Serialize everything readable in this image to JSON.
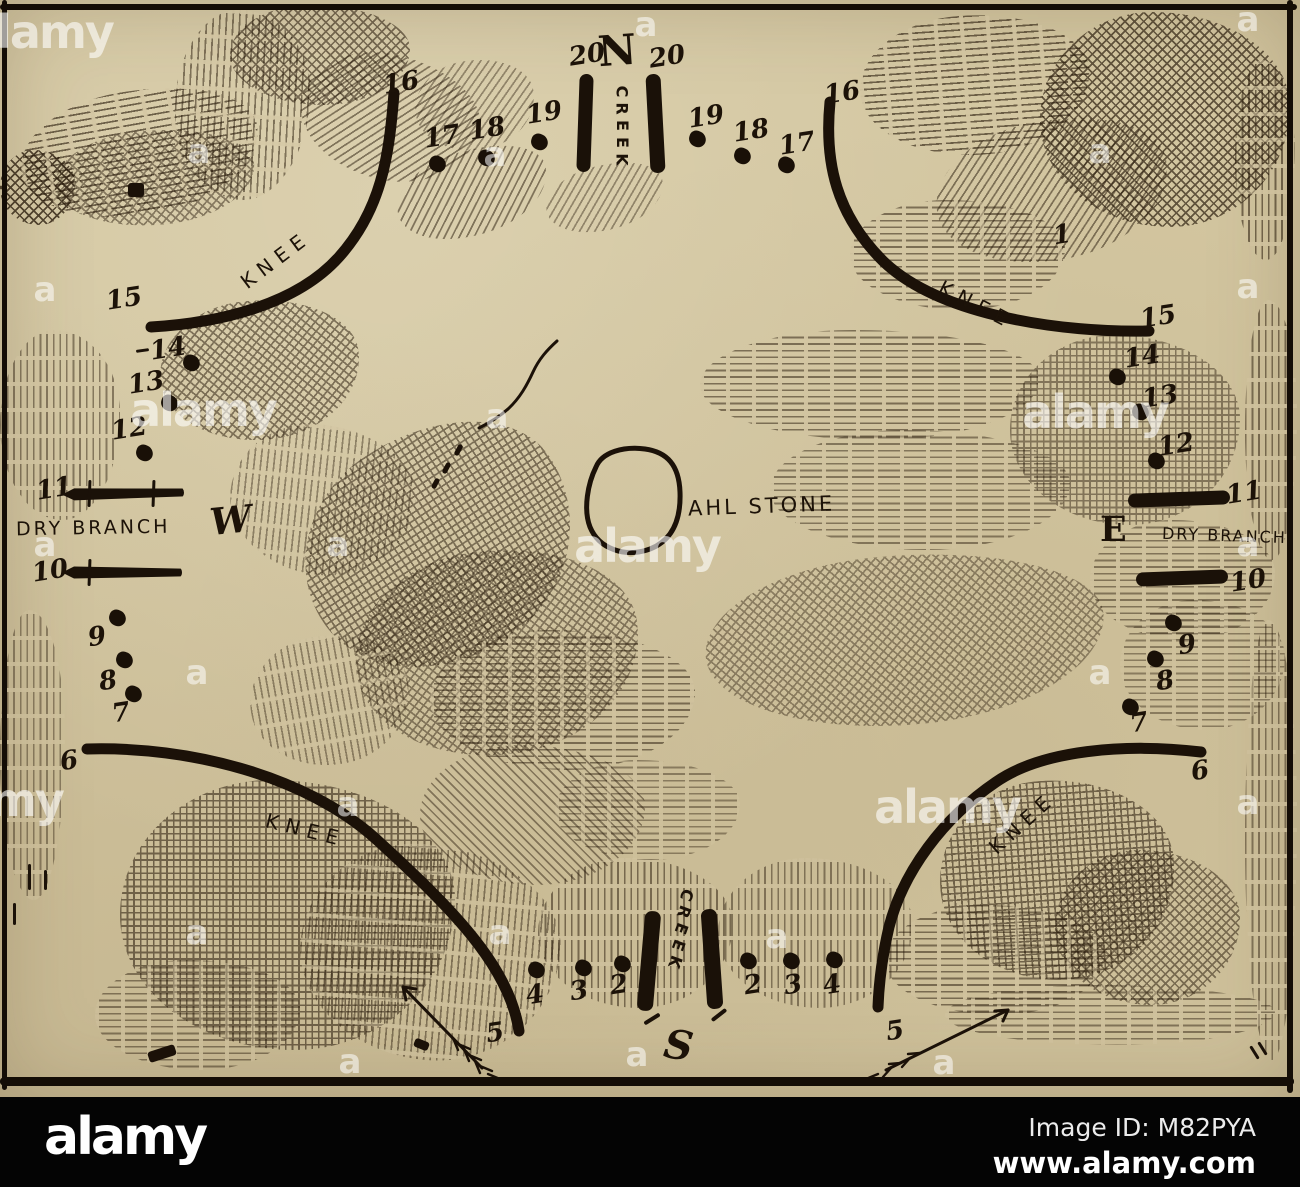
{
  "footer": {
    "logo": "alamy",
    "image_id": "Image ID: M82PYA",
    "url": "www.alamy.com"
  },
  "watermark": {
    "word": "alamy",
    "letter": "a",
    "word_tiles": [
      [
        40,
        32
      ],
      [
        203,
        410
      ],
      [
        1095,
        412
      ],
      [
        647,
        546
      ],
      [
        -10,
        800
      ],
      [
        947,
        807
      ]
    ],
    "letter_tiles": [
      [
        646,
        25
      ],
      [
        1248,
        20
      ],
      [
        199,
        152
      ],
      [
        495,
        155
      ],
      [
        1100,
        152
      ],
      [
        45,
        290
      ],
      [
        1248,
        287
      ],
      [
        497,
        417
      ],
      [
        45,
        545
      ],
      [
        338,
        545
      ],
      [
        1248,
        545
      ],
      [
        197,
        673
      ],
      [
        1100,
        673
      ],
      [
        348,
        805
      ],
      [
        1248,
        803
      ],
      [
        197,
        933
      ],
      [
        500,
        933
      ],
      [
        777,
        937
      ],
      [
        350,
        1062
      ],
      [
        637,
        1055
      ],
      [
        944,
        1063
      ]
    ]
  },
  "map": {
    "compass": {
      "north": "N",
      "south": "S",
      "east": "E",
      "west": "W"
    },
    "stone_label": "AHL STONE",
    "creek_label": "CREEK",
    "knee_label": "KNEE",
    "dry_branch_label": "DRY BRANCH",
    "knee_labels": [
      {
        "x": 243,
        "y": 272,
        "rot": -37
      },
      {
        "x": 940,
        "y": 274,
        "rot": 27
      },
      {
        "x": 266,
        "y": 808,
        "rot": 14
      },
      {
        "x": 992,
        "y": 838,
        "rot": -42
      }
    ],
    "stations": [
      {
        "label": "16",
        "lx": 383,
        "ly": 70
      },
      {
        "label": "17",
        "lx": 424,
        "ly": 124,
        "dx": 437,
        "dy": 164
      },
      {
        "label": "18",
        "lx": 469,
        "ly": 116,
        "dx": 486,
        "dy": 158
      },
      {
        "label": "19",
        "lx": 526,
        "ly": 100,
        "dx": 539,
        "dy": 142
      },
      {
        "label": "20",
        "lx": 569,
        "ly": 42
      },
      {
        "label": "20",
        "lx": 649,
        "ly": 44
      },
      {
        "label": "19",
        "lx": 688,
        "ly": 104,
        "dx": 697,
        "dy": 139
      },
      {
        "label": "18",
        "lx": 733,
        "ly": 118,
        "dx": 742,
        "dy": 156
      },
      {
        "label": "17",
        "lx": 779,
        "ly": 131,
        "dx": 786,
        "dy": 165
      },
      {
        "label": "16",
        "lx": 824,
        "ly": 80
      },
      {
        "label": "1",
        "lx": 1053,
        "ly": 222
      },
      {
        "label": "15",
        "lx": 106,
        "ly": 286
      },
      {
        "label": "14",
        "lx": 150,
        "ly": 336,
        "dx": 191,
        "dy": 363
      },
      {
        "label": "13",
        "lx": 128,
        "ly": 370,
        "dx": 169,
        "dy": 403
      },
      {
        "label": "12",
        "lx": 111,
        "ly": 416,
        "dx": 144,
        "dy": 453
      },
      {
        "label": "11",
        "lx": 36,
        "ly": 476
      },
      {
        "label": "10",
        "lx": 32,
        "ly": 558
      },
      {
        "label": "9",
        "lx": 88,
        "ly": 624,
        "dx": 117,
        "dy": 618
      },
      {
        "label": "8",
        "lx": 99,
        "ly": 668,
        "dx": 124,
        "dy": 660
      },
      {
        "label": "7",
        "lx": 112,
        "ly": 700,
        "dx": 133,
        "dy": 694
      },
      {
        "label": "6",
        "lx": 60,
        "ly": 748
      },
      {
        "label": "15",
        "lx": 1140,
        "ly": 304
      },
      {
        "label": "14",
        "lx": 1124,
        "ly": 344,
        "dx": 1117,
        "dy": 377
      },
      {
        "label": "13",
        "lx": 1142,
        "ly": 384,
        "dx": 1140,
        "dy": 412
      },
      {
        "label": "12",
        "lx": 1158,
        "ly": 432,
        "dx": 1156,
        "dy": 461
      },
      {
        "label": "11",
        "lx": 1226,
        "ly": 480
      },
      {
        "label": "10",
        "lx": 1230,
        "ly": 568
      },
      {
        "label": "9",
        "lx": 1178,
        "ly": 632,
        "dx": 1173,
        "dy": 623
      },
      {
        "label": "8",
        "lx": 1156,
        "ly": 668,
        "dx": 1155,
        "dy": 659
      },
      {
        "label": "7",
        "lx": 1130,
        "ly": 710,
        "dx": 1130,
        "dy": 707
      },
      {
        "label": "6",
        "lx": 1191,
        "ly": 758
      },
      {
        "label": "5",
        "lx": 486,
        "ly": 1020
      },
      {
        "label": "4",
        "lx": 526,
        "ly": 982,
        "dx": 536,
        "dy": 970
      },
      {
        "label": "3",
        "lx": 570,
        "ly": 978,
        "dx": 583,
        "dy": 968
      },
      {
        "label": "2",
        "lx": 610,
        "ly": 972,
        "dx": 622,
        "dy": 964
      },
      {
        "label": "2",
        "lx": 744,
        "ly": 972,
        "dx": 748,
        "dy": 961
      },
      {
        "label": "3",
        "lx": 784,
        "ly": 972,
        "dx": 791,
        "dy": 961
      },
      {
        "label": "4",
        "lx": 823,
        "ly": 972,
        "dx": 834,
        "dy": 960
      },
      {
        "label": "5",
        "lx": 886,
        "ly": 1018
      }
    ],
    "bars": [
      {
        "x": 578,
        "y": 74,
        "w": 14,
        "h": 98,
        "rot": 2
      },
      {
        "x": 648,
        "y": 74,
        "w": 15,
        "h": 99,
        "rot": -3
      },
      {
        "x": 641,
        "y": 911,
        "w": 16,
        "h": 100,
        "rot": 5
      },
      {
        "x": 704,
        "y": 909,
        "w": 16,
        "h": 100,
        "rot": -4
      },
      {
        "x": 62,
        "y": 487,
        "w": 122,
        "h": 13,
        "rot": -1,
        "pointed": true,
        "ticks": [
          88,
          152
        ]
      },
      {
        "x": 62,
        "y": 566,
        "w": 120,
        "h": 13,
        "rot": 0,
        "pointed": true,
        "ticks": [
          88
        ]
      },
      {
        "x": 1128,
        "y": 492,
        "w": 102,
        "h": 14,
        "rot": -2
      },
      {
        "x": 1136,
        "y": 571,
        "w": 92,
        "h": 14,
        "rot": -2
      }
    ]
  }
}
